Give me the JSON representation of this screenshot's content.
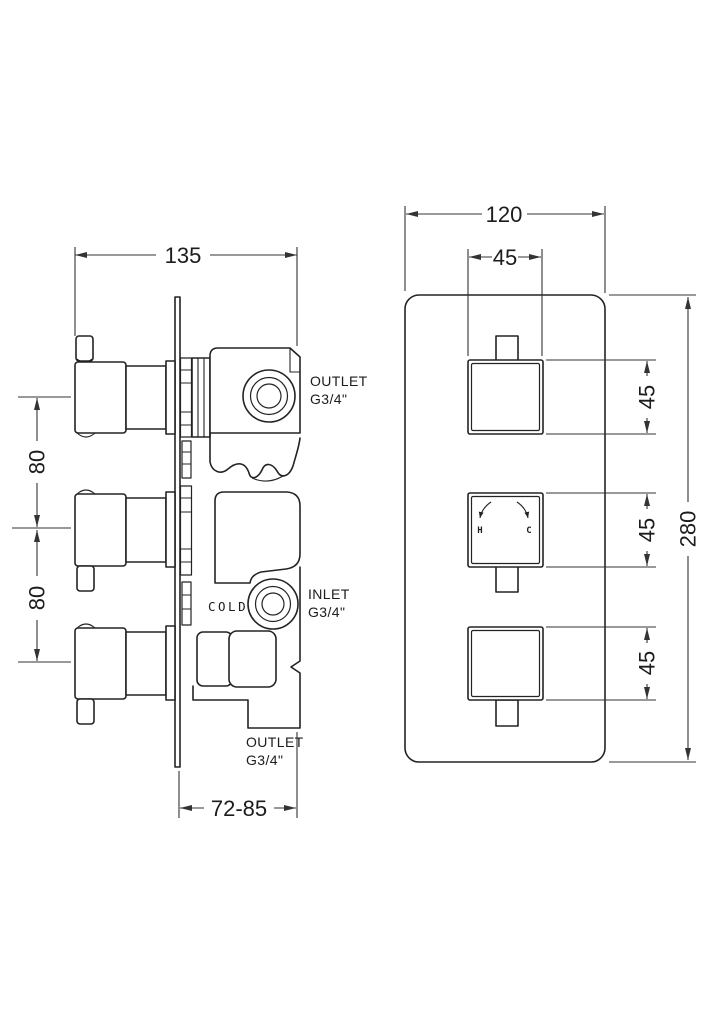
{
  "colors": {
    "line": "#232323",
    "background": "#ffffff"
  },
  "left_view": {
    "dim_width": "135",
    "dim_pitch_top": "80",
    "dim_pitch_bottom": "80",
    "dim_depth_range": "72-85",
    "labels": {
      "outlet_top": {
        "line1": "OUTLET",
        "line2": "G3/4\""
      },
      "inlet": {
        "line1": "INLET",
        "line2": "G3/4\""
      },
      "outlet_bottom": {
        "line1": "OUTLET",
        "line2": "G3/4\""
      },
      "cold": "COLD"
    }
  },
  "right_view": {
    "dim_plate_width": "120",
    "dim_handle_width": "45",
    "dim_handle_heights": [
      "45",
      "45",
      "45"
    ],
    "dim_plate_height": "280",
    "hot_label": "H",
    "cold_label": "C"
  }
}
